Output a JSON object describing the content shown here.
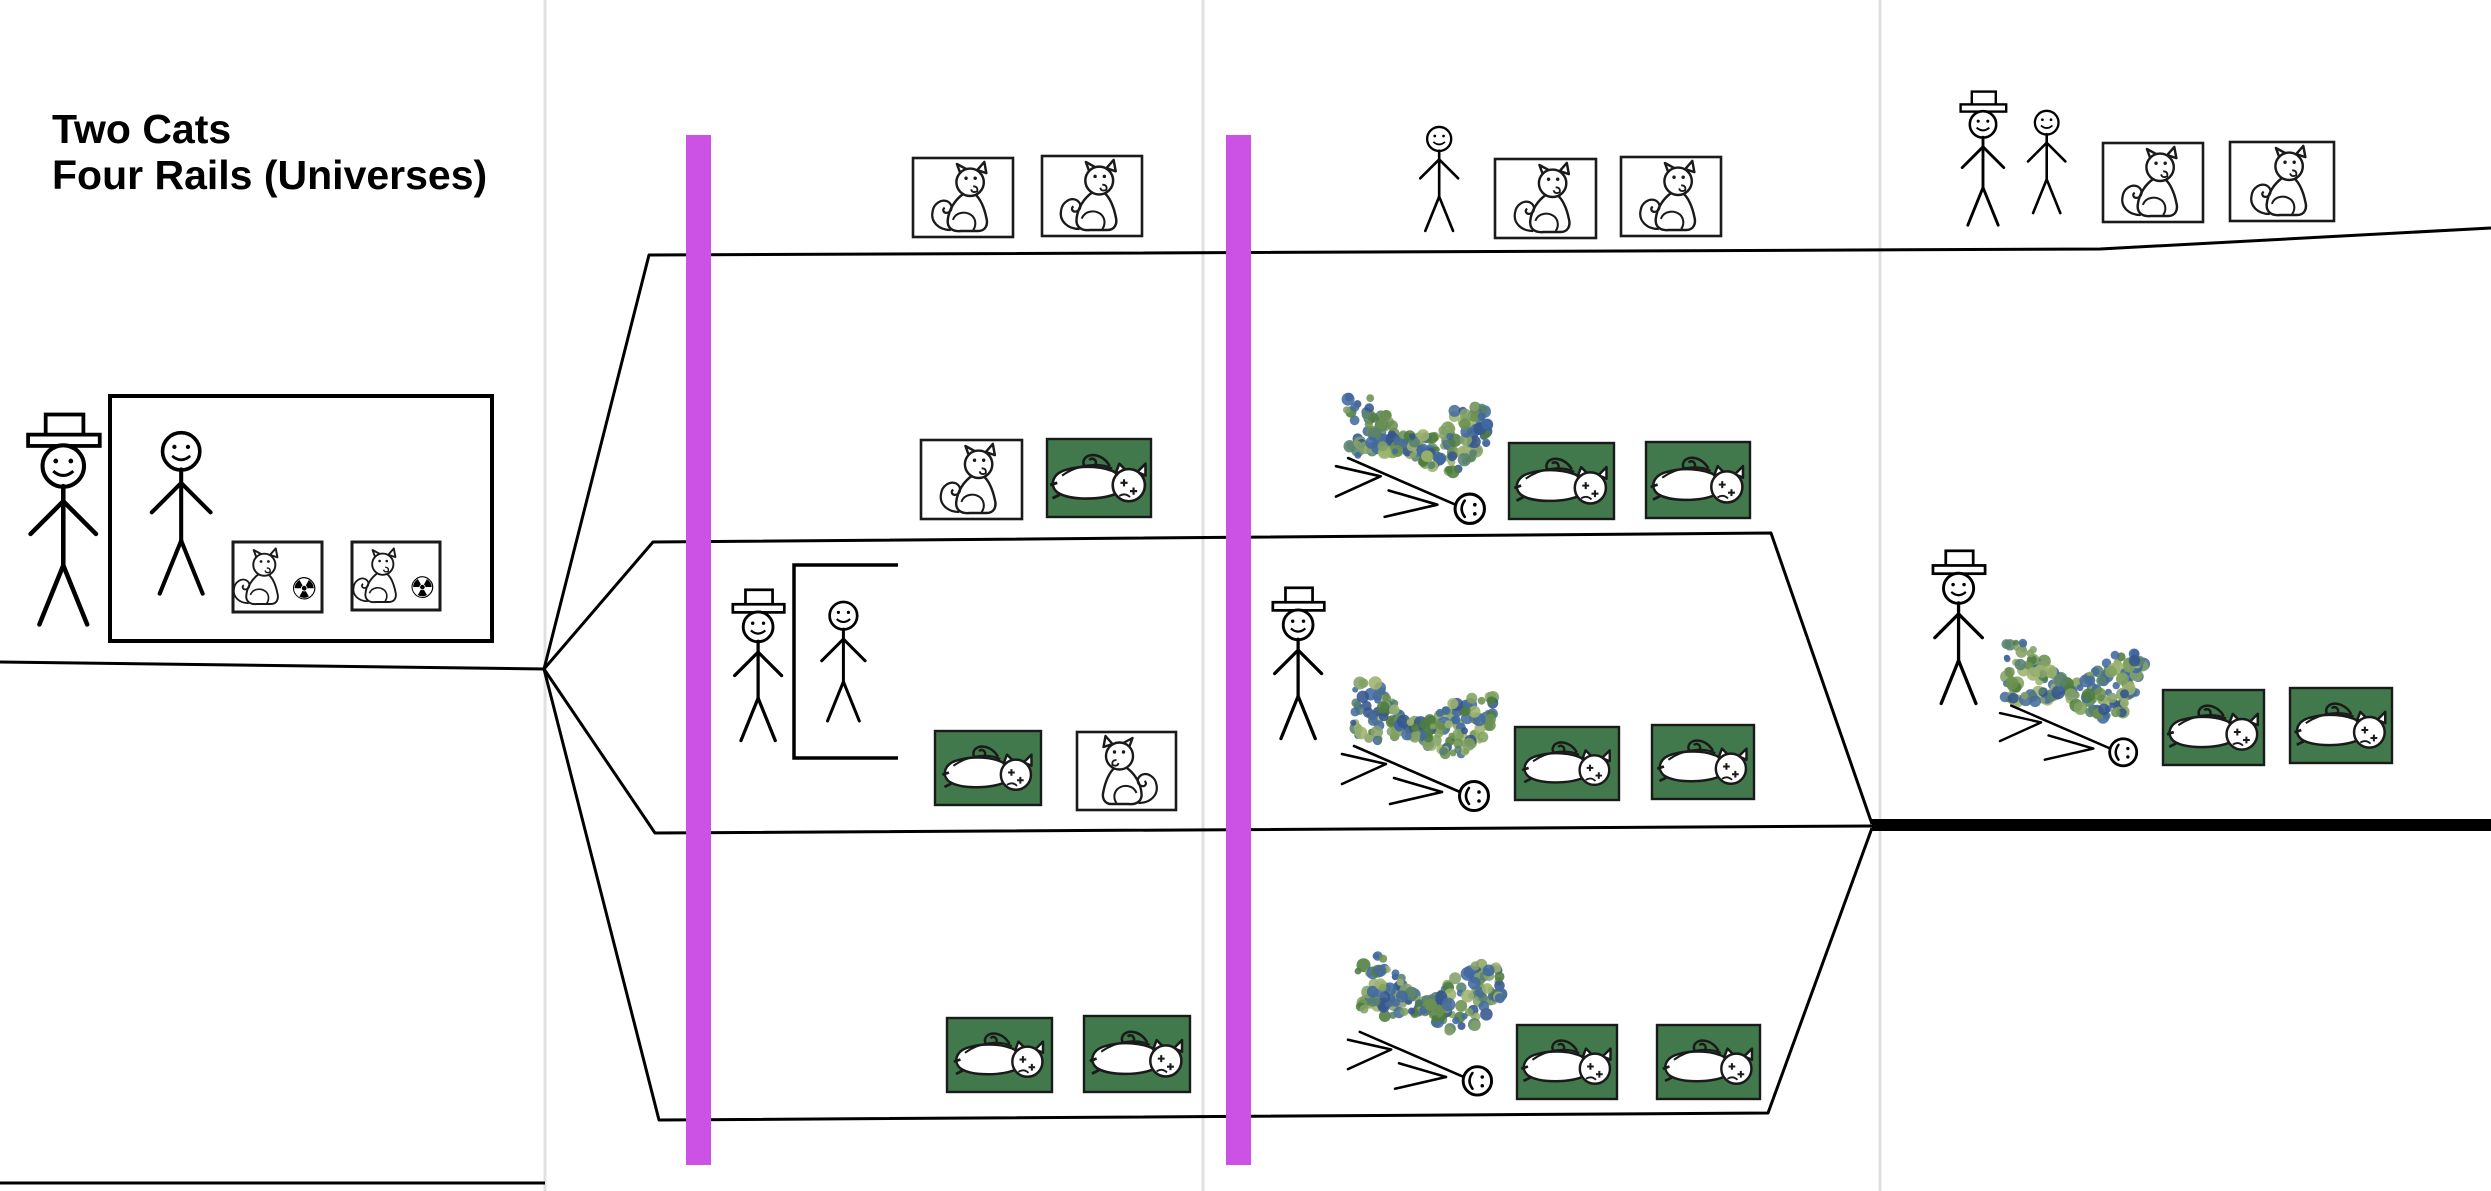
{
  "title": {
    "line1": "Two Cats",
    "line2": "Four Rails (Universes)"
  },
  "colors": {
    "line": "#000000",
    "divider": "#e0e0e0",
    "magenta_bar": "#cc52e6",
    "dead_box_green": "#41794c",
    "box_border": "#1a1a1a",
    "scribble_palette": [
      "#6b9150",
      "#4e7d3f",
      "#41699f",
      "#36558e",
      "#7fa35f",
      "#58816f",
      "#9db36e",
      "#466c9c",
      "#84a06a"
    ]
  },
  "scene": {
    "canvas": {
      "w": 2491,
      "h": 1191
    },
    "dividers": [
      {
        "x": 545
      },
      {
        "x": 1203
      },
      {
        "x": 1880
      }
    ],
    "barriers": [
      {
        "name": "magenta-barrier-1",
        "x": 686,
        "y": 135,
        "w": 25,
        "h": 1030
      },
      {
        "name": "magenta-barrier-2",
        "x": 1226,
        "y": 135,
        "w": 25,
        "h": 1030
      }
    ],
    "rails": [
      {
        "name": "incoming-worldline",
        "points": [
          [
            0,
            662
          ],
          [
            544,
            669
          ]
        ]
      },
      {
        "name": "rail-1-top",
        "points": [
          [
            544,
            669
          ],
          [
            649,
            255
          ],
          [
            2100,
            249
          ],
          [
            2491,
            228
          ]
        ]
      },
      {
        "name": "rail-2",
        "points": [
          [
            544,
            669
          ],
          [
            653,
            542
          ],
          [
            1771,
            533
          ],
          [
            1872,
            824
          ]
        ]
      },
      {
        "name": "rail-3",
        "points": [
          [
            544,
            669
          ],
          [
            655,
            833
          ],
          [
            1872,
            826
          ]
        ]
      },
      {
        "name": "rail-4",
        "points": [
          [
            544,
            669
          ],
          [
            659,
            1120
          ],
          [
            1768,
            1113
          ],
          [
            1872,
            828
          ]
        ]
      },
      {
        "name": "bottom-left-line",
        "points": [
          [
            0,
            1183
          ],
          [
            545,
            1183
          ]
        ]
      }
    ],
    "thick_line": {
      "name": "merged-worldline",
      "x": 1872,
      "y": 819,
      "w": 619,
      "h": 12
    },
    "intro_box": {
      "x": 110,
      "y": 396,
      "w": 382,
      "h": 245
    },
    "open_box": {
      "x": 794,
      "y": 565,
      "w": 104,
      "h": 193
    },
    "figures": [
      {
        "name": "observer-with-hat-start",
        "hat": true,
        "x": 13,
        "y": 412,
        "h": 220
      },
      {
        "name": "friend-in-box-start",
        "hat": false,
        "x": 136,
        "y": 422,
        "h": 192
      },
      {
        "name": "observer-with-hat-rail3",
        "hat": true,
        "x": 722,
        "y": 588,
        "h": 158
      },
      {
        "name": "friend-in-open-box-rail3",
        "hat": false,
        "x": 810,
        "y": 594,
        "h": 142
      },
      {
        "name": "friend-panel3-rail1",
        "hat": false,
        "x": 1410,
        "y": 120,
        "h": 124
      },
      {
        "name": "observer-panel3-rail3",
        "hat": true,
        "x": 1262,
        "y": 586,
        "h": 158
      },
      {
        "name": "observer-panel4-rail1",
        "hat": true,
        "x": 1951,
        "y": 90,
        "h": 140
      },
      {
        "name": "friend-panel4-rail1",
        "hat": false,
        "x": 2018,
        "y": 104,
        "h": 122
      },
      {
        "name": "observer-panel4-rail3",
        "hat": true,
        "x": 1922,
        "y": 549,
        "h": 160
      }
    ],
    "alive_boxes": [
      {
        "x": 913,
        "y": 158,
        "w": 100,
        "h": 79
      },
      {
        "x": 1042,
        "y": 156,
        "w": 100,
        "h": 80
      },
      {
        "x": 921,
        "y": 440,
        "w": 101,
        "h": 79
      },
      {
        "x": 1077,
        "y": 732,
        "w": 99,
        "h": 78,
        "flip": true
      },
      {
        "x": 1495,
        "y": 159,
        "w": 101,
        "h": 79
      },
      {
        "x": 1621,
        "y": 157,
        "w": 100,
        "h": 79
      },
      {
        "x": 2103,
        "y": 143,
        "w": 100,
        "h": 79
      },
      {
        "x": 2230,
        "y": 142,
        "w": 104,
        "h": 79
      }
    ],
    "radiation_boxes": [
      {
        "x": 233,
        "y": 542,
        "w": 89,
        "h": 70
      },
      {
        "x": 352,
        "y": 542,
        "w": 88,
        "h": 68
      }
    ],
    "radiation_symbol": "☢",
    "dead_boxes": [
      {
        "x": 1047,
        "y": 439,
        "w": 104,
        "h": 78
      },
      {
        "x": 935,
        "y": 731,
        "w": 106,
        "h": 74
      },
      {
        "x": 947,
        "y": 1018,
        "w": 105,
        "h": 74
      },
      {
        "x": 1084,
        "y": 1016,
        "w": 106,
        "h": 76
      },
      {
        "x": 1509,
        "y": 443,
        "w": 105,
        "h": 76
      },
      {
        "x": 1646,
        "y": 442,
        "w": 104,
        "h": 76
      },
      {
        "x": 1515,
        "y": 727,
        "w": 104,
        "h": 73
      },
      {
        "x": 1652,
        "y": 725,
        "w": 102,
        "h": 74
      },
      {
        "x": 1517,
        "y": 1025,
        "w": 100,
        "h": 74
      },
      {
        "x": 1657,
        "y": 1025,
        "w": 103,
        "h": 74
      },
      {
        "x": 2163,
        "y": 690,
        "w": 101,
        "h": 75
      },
      {
        "x": 2290,
        "y": 688,
        "w": 102,
        "h": 75
      }
    ],
    "scribbles": [
      {
        "x": 1345,
        "y": 400,
        "w": 145,
        "h": 70
      },
      {
        "x": 1353,
        "y": 686,
        "w": 142,
        "h": 68
      },
      {
        "x": 1358,
        "y": 959,
        "w": 144,
        "h": 72
      },
      {
        "x": 2005,
        "y": 646,
        "w": 140,
        "h": 72
      }
    ],
    "fallen_figures": [
      {
        "x": 1336,
        "y": 452,
        "w": 152,
        "h": 66
      },
      {
        "x": 1342,
        "y": 740,
        "w": 150,
        "h": 64
      },
      {
        "x": 1348,
        "y": 1026,
        "w": 147,
        "h": 64
      },
      {
        "x": 2000,
        "y": 700,
        "w": 140,
        "h": 64
      }
    ]
  }
}
